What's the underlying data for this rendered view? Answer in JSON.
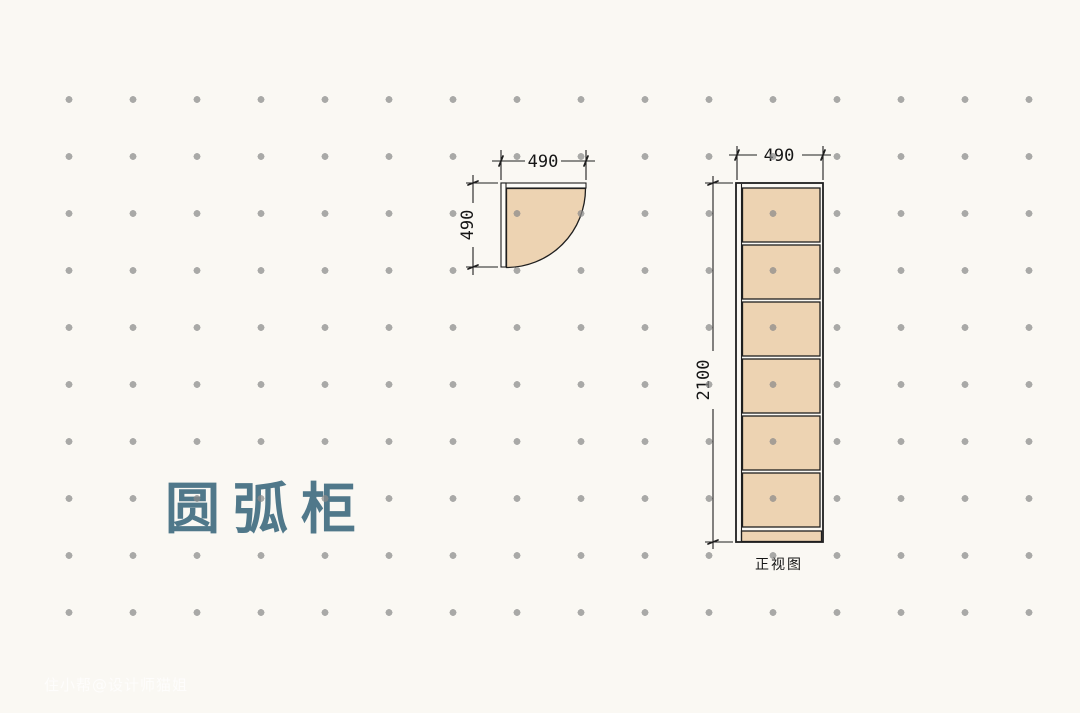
{
  "title": {
    "text": "圆弧柜"
  },
  "watermark": {
    "text": "住小帮@设计师猫姐"
  },
  "plan_view": {
    "width_label": "490",
    "depth_label": "490"
  },
  "elevation_view": {
    "width_label": "490",
    "height_label": "2100",
    "caption": "正视图",
    "compartments": 6
  },
  "colors": {
    "background": "#faf8f3",
    "dot": "#8a8a8a",
    "wood": "#edd3b2",
    "line": "#1f1f1f",
    "title": "#50788a",
    "panel": "#fdfcf8"
  }
}
